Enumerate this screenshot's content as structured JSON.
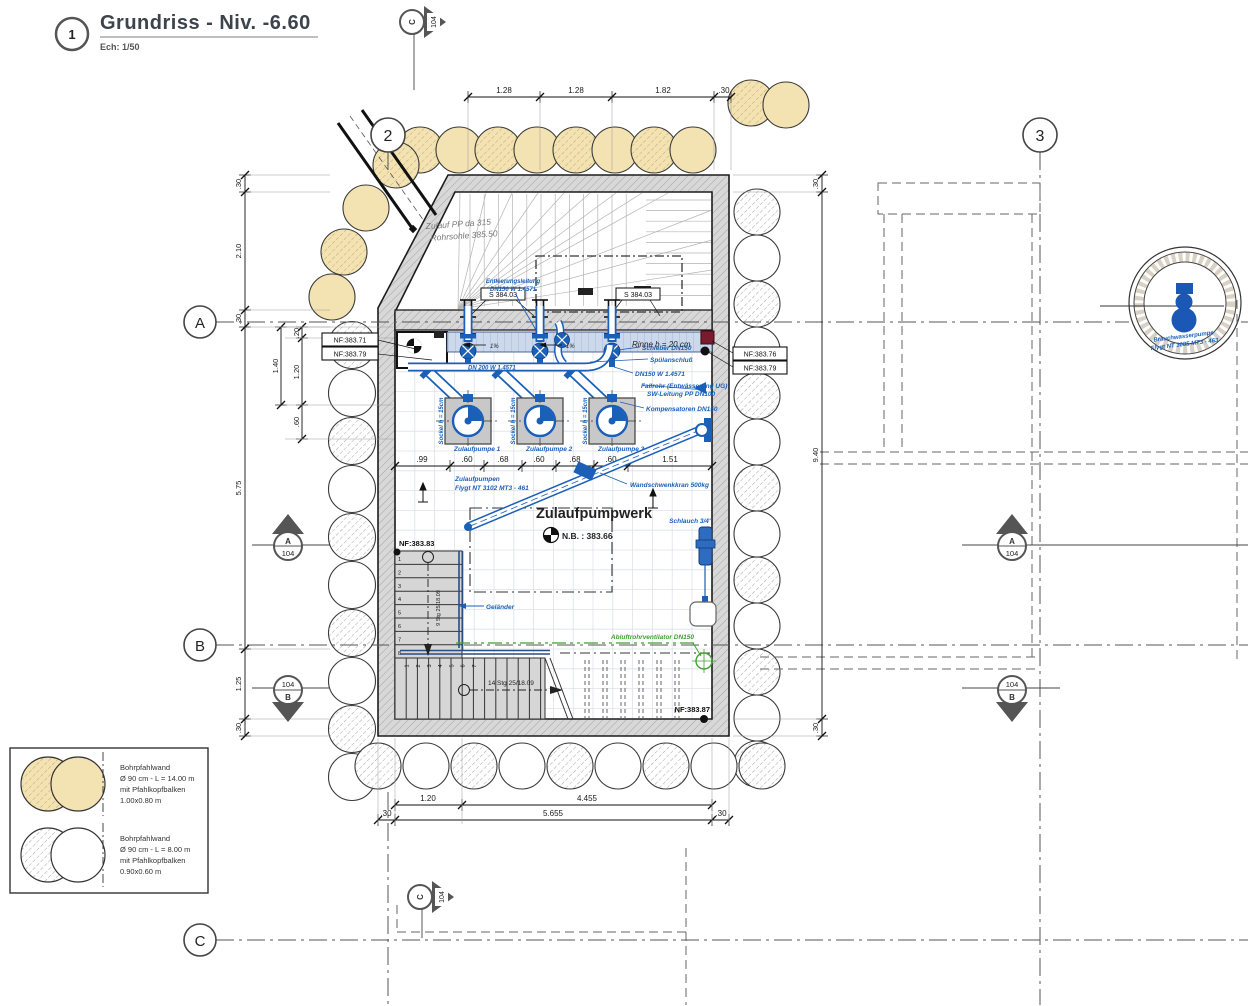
{
  "title_block": {
    "index": "1",
    "title": "Grundriss - Niv. -6.60",
    "scale": "Ech: 1/50"
  },
  "grid": {
    "col_2": "2",
    "col_3": "3",
    "row_a": "A",
    "row_b": "B",
    "row_c": "C"
  },
  "sections": {
    "sheet": "104",
    "a": "A",
    "b": "B",
    "c": "C"
  },
  "dims": {
    "top": [
      "1.28",
      "1.28",
      "1.82",
      ".30"
    ],
    "left_outer": [
      ".30",
      "2.10",
      ".30",
      "5.75",
      "1.25",
      ".30"
    ],
    "left_inner": [
      ".20",
      "1.20",
      ".60",
      "1.40"
    ],
    "right": [
      ".30",
      "9.40",
      ".30"
    ],
    "bottom_row1": [
      "1.20",
      "4.455"
    ],
    "bottom_row2": [
      ".30",
      "5.655",
      ".30"
    ],
    "pump_row": [
      ".99",
      ".60",
      ".68",
      ".60",
      ".68",
      ".60",
      "1.51"
    ]
  },
  "levels": {
    "nf_left_1": "NF:383.71",
    "nf_left_2": "NF:383.79",
    "nf_right_1": "NF:383.76",
    "nf_right_2": "NF:383.79",
    "nf_stairs": "NF:383.83",
    "nf_floor": "NF:383.87",
    "s_upper_left": "S 384.03",
    "s_upper_right": "S 384.03",
    "nb_basin": "N.B. : 383.66"
  },
  "annotations": {
    "zulauf_line1": "Zulauf PP da 315",
    "zulauf_line2": "Rohrsohle 385.50",
    "entleerung_line1": "Entleerungsleitung",
    "entleerung_line2": "DN150 W 1.4571",
    "rinne": "Rinne b = 20 cm",
    "slope_1": "1%",
    "slope_2": "1%",
    "schieber": "Schieber DN150",
    "spuelanschluss": "Spülanschluß",
    "dn150": "DN150 W 1.4571",
    "fallrohr_line1": "Fallrohr (Entwässerung UG)",
    "fallrohr_line2": "SW-Leitung  PP DN100",
    "kompensatoren": "Kompensatoren DN150",
    "dn200": "DN 200 W 1.4571",
    "sockel": "Sockel h = 15cm",
    "pumpe_1": "Zulaufpumpe 1",
    "pumpe_2": "Zulaufpumpe 2",
    "pumpe_3": "Zulaufpumpe 3",
    "pumpen_line1": "Zulaufpumpen",
    "pumpen_line2": "Flygt NT 3102 MT3 - 461",
    "kran": "Wandschwenkkran 500kg",
    "room": "Zulaufpumpwerk",
    "gelaender": "Geländer",
    "schlauch": "Schlauch 3/4\"",
    "abluft": "Abluftrohrventilator DN150",
    "stairs_lower": "14 Stg 25/18.09",
    "stairs_upper": "9 Stg 25/18.09",
    "detail_line1": "Brauchwasserpumpe",
    "detail_line2": "Flygt NT 3085 MT3 - 463"
  },
  "stairs": {
    "upper_numbers": [
      "1",
      "2",
      "3",
      "4",
      "5",
      "6",
      "7",
      "8"
    ],
    "lower_numbers": [
      "1",
      "2",
      "3",
      "4",
      "5",
      "6",
      "7"
    ]
  },
  "legend": {
    "items": [
      {
        "line1": "Bohrpfahlwand",
        "line2": "Ø 90 cm - L = 14.00 m",
        "line3": "mit Pfahlkopfbalken",
        "line4": "1.00x0.80 m"
      },
      {
        "line1": "Bohrpfahlwand",
        "line2": "Ø 90 cm - L = 8.00 m",
        "line3": "mit Pfahlkopfbalken",
        "line4": "0.90x0.60 m"
      }
    ]
  },
  "colors": {
    "annotation_blue": "#1a5fb8",
    "pile_yellow": "#f4e3b2",
    "vent_green": "#3f9f2f",
    "wall_gray": "#d8d8d8",
    "marker_red": "#7c1a2d"
  }
}
